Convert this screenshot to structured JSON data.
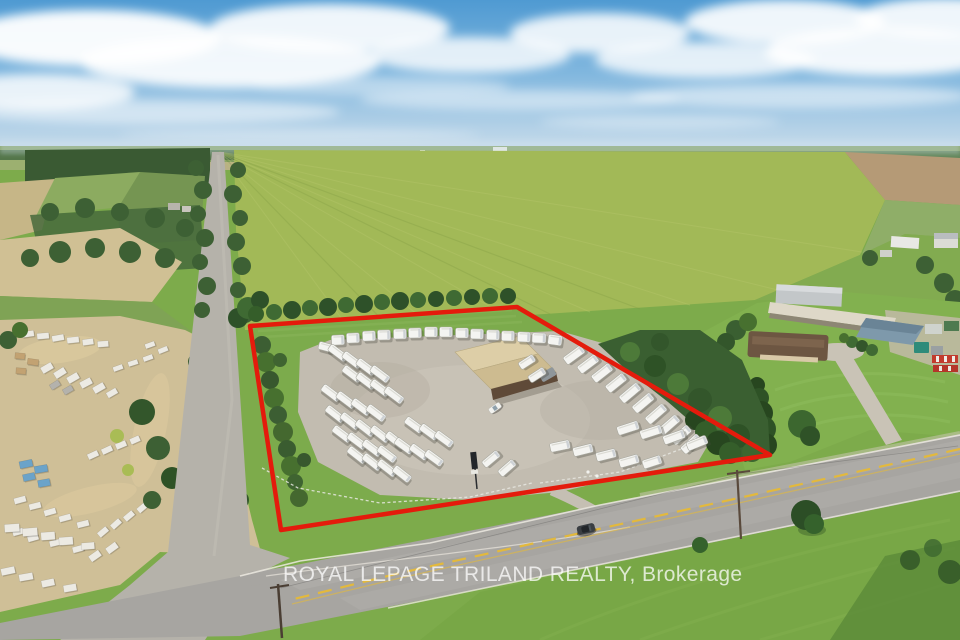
{
  "watermark": {
    "text": "ROYAL LEPAGE TRILAND REALTY, Brokerage"
  },
  "palette": {
    "boundary_red": "#e41b0c",
    "sky_top": "#4f9ad2",
    "sky_horizon": "#d3e2ee",
    "grass": "#7dab4b",
    "gravel": "#c2bcb0",
    "asphalt": "#a7a5a1",
    "rv_white": "#f4f4f1",
    "roof_tan_light": "#ddcea7",
    "roof_tan_dark": "#cdbb90",
    "wall_brown": "#5f4a38",
    "suv_grey": "#3a3e42",
    "pallet_white": "#eceae3",
    "pallet_blue": "#6ba3c9",
    "pallet_tan": "#c2a272",
    "pallet_grey": "#b4b2ac"
  },
  "boundary": {
    "stroke_width": 4.5,
    "points": [
      [
        250,
        326
      ],
      [
        517,
        307
      ],
      [
        770,
        455
      ],
      [
        281,
        530
      ]
    ]
  },
  "building": {
    "roof_upper": [
      [
        455,
        352
      ],
      [
        520,
        336
      ],
      [
        538,
        354
      ],
      [
        473,
        371
      ]
    ],
    "roof_lower": [
      [
        473,
        371
      ],
      [
        538,
        354
      ],
      [
        556,
        372
      ],
      [
        491,
        389
      ]
    ],
    "front_wall": [
      [
        491,
        389
      ],
      [
        556,
        372
      ],
      [
        558,
        381
      ],
      [
        493,
        400
      ]
    ],
    "shadow": [
      [
        493,
        399
      ],
      [
        557,
        381
      ],
      [
        562,
        387
      ],
      [
        498,
        405
      ]
    ]
  },
  "rvs": [
    [
      338,
      340,
      13,
      10,
      -2
    ],
    [
      353,
      338,
      13,
      10,
      -2
    ],
    [
      369,
      336,
      13,
      10,
      -2
    ],
    [
      384,
      335,
      13,
      10,
      -1
    ],
    [
      400,
      334,
      13,
      10,
      -1
    ],
    [
      415,
      333,
      13,
      10,
      -1
    ],
    [
      431,
      332,
      13,
      10,
      0
    ],
    [
      446,
      332,
      13,
      10,
      0
    ],
    [
      462,
      333,
      13,
      10,
      0
    ],
    [
      477,
      334,
      13,
      10,
      1
    ],
    [
      493,
      335,
      13,
      10,
      1
    ],
    [
      508,
      336,
      13,
      10,
      1
    ],
    [
      524,
      337,
      13,
      10,
      2
    ],
    [
      539,
      338,
      14,
      10,
      2
    ],
    [
      555,
      340,
      14,
      10,
      8
    ],
    [
      574,
      355,
      22,
      9,
      -36
    ],
    [
      588,
      364,
      22,
      9,
      -37
    ],
    [
      602,
      373,
      22,
      9,
      -38
    ],
    [
      616,
      383,
      22,
      9,
      -39
    ],
    [
      630,
      393,
      23,
      9,
      -40
    ],
    [
      643,
      403,
      23,
      9,
      -40
    ],
    [
      656,
      414,
      23,
      9,
      -41
    ],
    [
      669,
      425,
      23,
      9,
      -41
    ],
    [
      681,
      435,
      22,
      9,
      -42
    ],
    [
      691,
      444,
      22,
      9,
      -42
    ],
    [
      628,
      428,
      22,
      9,
      -18
    ],
    [
      651,
      432,
      22,
      9,
      -18
    ],
    [
      674,
      437,
      22,
      9,
      -20
    ],
    [
      697,
      443,
      21,
      9,
      -22
    ],
    [
      560,
      446,
      20,
      9,
      -12
    ],
    [
      583,
      450,
      20,
      9,
      -14
    ],
    [
      606,
      455,
      20,
      9,
      -14
    ],
    [
      629,
      461,
      20,
      9,
      -16
    ],
    [
      652,
      462,
      19,
      9,
      -18
    ],
    [
      527,
      362,
      17,
      8,
      -33
    ],
    [
      537,
      375,
      18,
      8,
      -33
    ],
    [
      491,
      459,
      19,
      8,
      -40
    ],
    [
      507,
      468,
      19,
      8,
      -41
    ],
    [
      326,
      347,
      15,
      8,
      15
    ],
    [
      338,
      353,
      21,
      8,
      37
    ],
    [
      352,
      360,
      21,
      8,
      37
    ],
    [
      366,
      367,
      21,
      8,
      37
    ],
    [
      380,
      374,
      21,
      8,
      37
    ],
    [
      352,
      374,
      21,
      8,
      37
    ],
    [
      366,
      381,
      21,
      8,
      37
    ],
    [
      380,
      388,
      21,
      8,
      37
    ],
    [
      394,
      395,
      21,
      8,
      37
    ],
    [
      331,
      393,
      21,
      8,
      37
    ],
    [
      346,
      400,
      21,
      8,
      37
    ],
    [
      361,
      407,
      21,
      8,
      37
    ],
    [
      376,
      413,
      21,
      8,
      37
    ],
    [
      335,
      414,
      21,
      8,
      38
    ],
    [
      350,
      421,
      21,
      8,
      38
    ],
    [
      365,
      428,
      21,
      8,
      38
    ],
    [
      380,
      434,
      21,
      8,
      38
    ],
    [
      395,
      440,
      21,
      8,
      38
    ],
    [
      342,
      434,
      21,
      8,
      37
    ],
    [
      357,
      441,
      21,
      8,
      37
    ],
    [
      372,
      448,
      21,
      8,
      37
    ],
    [
      387,
      454,
      21,
      8,
      37
    ],
    [
      357,
      455,
      21,
      8,
      38
    ],
    [
      372,
      462,
      21,
      8,
      38
    ],
    [
      387,
      468,
      21,
      8,
      38
    ],
    [
      402,
      474,
      20,
      8,
      38
    ],
    [
      404,
      446,
      20,
      8,
      36
    ],
    [
      419,
      452,
      20,
      8,
      36
    ],
    [
      434,
      458,
      20,
      8,
      36
    ],
    [
      414,
      425,
      20,
      8,
      36
    ],
    [
      429,
      432,
      20,
      8,
      36
    ],
    [
      444,
      439,
      20,
      8,
      36
    ]
  ],
  "pallets": [
    [
      28,
      334,
      12,
      6,
      -8,
      "w"
    ],
    [
      43,
      336,
      12,
      6,
      -5,
      "w"
    ],
    [
      58,
      338,
      12,
      6,
      -10,
      "w"
    ],
    [
      73,
      340,
      12,
      6,
      -6,
      "w"
    ],
    [
      88,
      342,
      11,
      6,
      -8,
      "w"
    ],
    [
      103,
      344,
      11,
      6,
      -4,
      "w"
    ],
    [
      20,
      356,
      10,
      6,
      5,
      "t"
    ],
    [
      33,
      362,
      11,
      6,
      8,
      "t"
    ],
    [
      21,
      371,
      10,
      6,
      4,
      "t"
    ],
    [
      47,
      368,
      12,
      7,
      -30,
      "w"
    ],
    [
      60,
      373,
      12,
      7,
      -32,
      "w"
    ],
    [
      73,
      378,
      12,
      7,
      -30,
      "w"
    ],
    [
      86,
      383,
      12,
      7,
      -28,
      "w"
    ],
    [
      99,
      388,
      12,
      7,
      -30,
      "w"
    ],
    [
      112,
      393,
      11,
      6,
      -30,
      "w"
    ],
    [
      55,
      385,
      10,
      6,
      -32,
      "g"
    ],
    [
      68,
      390,
      10,
      6,
      -30,
      "g"
    ],
    [
      150,
      345,
      10,
      5,
      -20,
      "w"
    ],
    [
      163,
      350,
      10,
      5,
      -22,
      "w"
    ],
    [
      148,
      358,
      10,
      5,
      -20,
      "w"
    ],
    [
      133,
      363,
      10,
      5,
      -18,
      "w"
    ],
    [
      118,
      368,
      10,
      5,
      -20,
      "w"
    ],
    [
      26,
      464,
      13,
      7,
      -12,
      "b"
    ],
    [
      41,
      469,
      13,
      7,
      -10,
      "b"
    ],
    [
      29,
      477,
      12,
      7,
      -12,
      "b"
    ],
    [
      44,
      483,
      12,
      7,
      -10,
      "b"
    ],
    [
      93,
      455,
      11,
      6,
      -25,
      "w"
    ],
    [
      107,
      450,
      11,
      6,
      -25,
      "w"
    ],
    [
      121,
      445,
      11,
      6,
      -23,
      "w"
    ],
    [
      135,
      440,
      10,
      6,
      -24,
      "w"
    ],
    [
      20,
      500,
      12,
      6,
      -15,
      "w"
    ],
    [
      35,
      506,
      12,
      6,
      -14,
      "w"
    ],
    [
      50,
      512,
      12,
      6,
      -16,
      "w"
    ],
    [
      65,
      518,
      12,
      6,
      -15,
      "w"
    ],
    [
      83,
      524,
      12,
      6,
      -14,
      "w"
    ],
    [
      18,
      532,
      11,
      6,
      -15,
      "w"
    ],
    [
      33,
      538,
      11,
      6,
      -16,
      "w"
    ],
    [
      55,
      543,
      11,
      6,
      -14,
      "w"
    ],
    [
      78,
      549,
      11,
      6,
      -15,
      "w"
    ],
    [
      103,
      532,
      11,
      6,
      -40,
      "w"
    ],
    [
      116,
      524,
      11,
      6,
      -42,
      "w"
    ],
    [
      129,
      516,
      11,
      6,
      -40,
      "w"
    ],
    [
      142,
      508,
      10,
      6,
      -41,
      "w"
    ],
    [
      155,
      500,
      10,
      6,
      -40,
      "w"
    ],
    [
      12,
      528,
      15,
      8,
      -4,
      "w"
    ],
    [
      30,
      532,
      15,
      8,
      -5,
      "w"
    ],
    [
      48,
      536,
      14,
      8,
      -4,
      "w"
    ],
    [
      66,
      541,
      14,
      8,
      -4,
      "w"
    ],
    [
      88,
      546,
      13,
      7,
      -5,
      "w"
    ],
    [
      95,
      556,
      12,
      7,
      -35,
      "w"
    ],
    [
      112,
      548,
      12,
      7,
      -36,
      "w"
    ],
    [
      8,
      571,
      14,
      7,
      -12,
      "w"
    ],
    [
      26,
      577,
      14,
      7,
      -10,
      "w"
    ],
    [
      48,
      583,
      13,
      7,
      -12,
      "w"
    ],
    [
      70,
      588,
      13,
      7,
      -10,
      "w"
    ],
    [
      738,
      441,
      12,
      8,
      4,
      "w"
    ]
  ],
  "vehicles": {
    "suv": {
      "x": 586,
      "y": 529,
      "rot": -13
    },
    "white_car": {
      "x": 495,
      "y": 408,
      "rot": -35
    }
  }
}
